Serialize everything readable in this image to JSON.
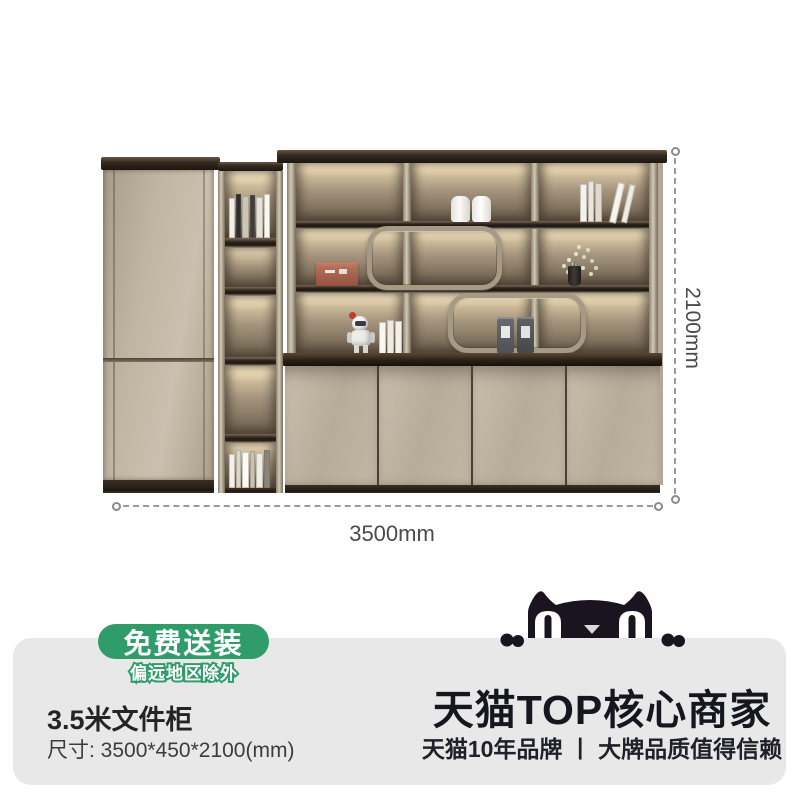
{
  "annotations": {
    "width_label": "3500mm",
    "height_label": "2100mm"
  },
  "shipping_badge": {
    "main": "免费送装",
    "sub": "偏远地区除外"
  },
  "product_info": {
    "title": "3.5米文件柜",
    "size": "尺寸: 3500*450*2100(mm)"
  },
  "merchant": {
    "headline": "天猫TOP核心商家",
    "subline": "天猫10年品牌 丨 大牌品质值得信赖"
  },
  "icons": {
    "tmall_cat": "tmall-cat-icon"
  },
  "colors": {
    "badge_green": "#2f9c6a",
    "panel_gray": "#e8e8e8",
    "ink": "#16161e",
    "cabinet_greige": "#b9ae9d",
    "dark_wood": "#2b2119",
    "champagne_frame": "#a69a84",
    "backlight_glow": "#f7edd5",
    "dimension_line": "#9a9a9a"
  }
}
